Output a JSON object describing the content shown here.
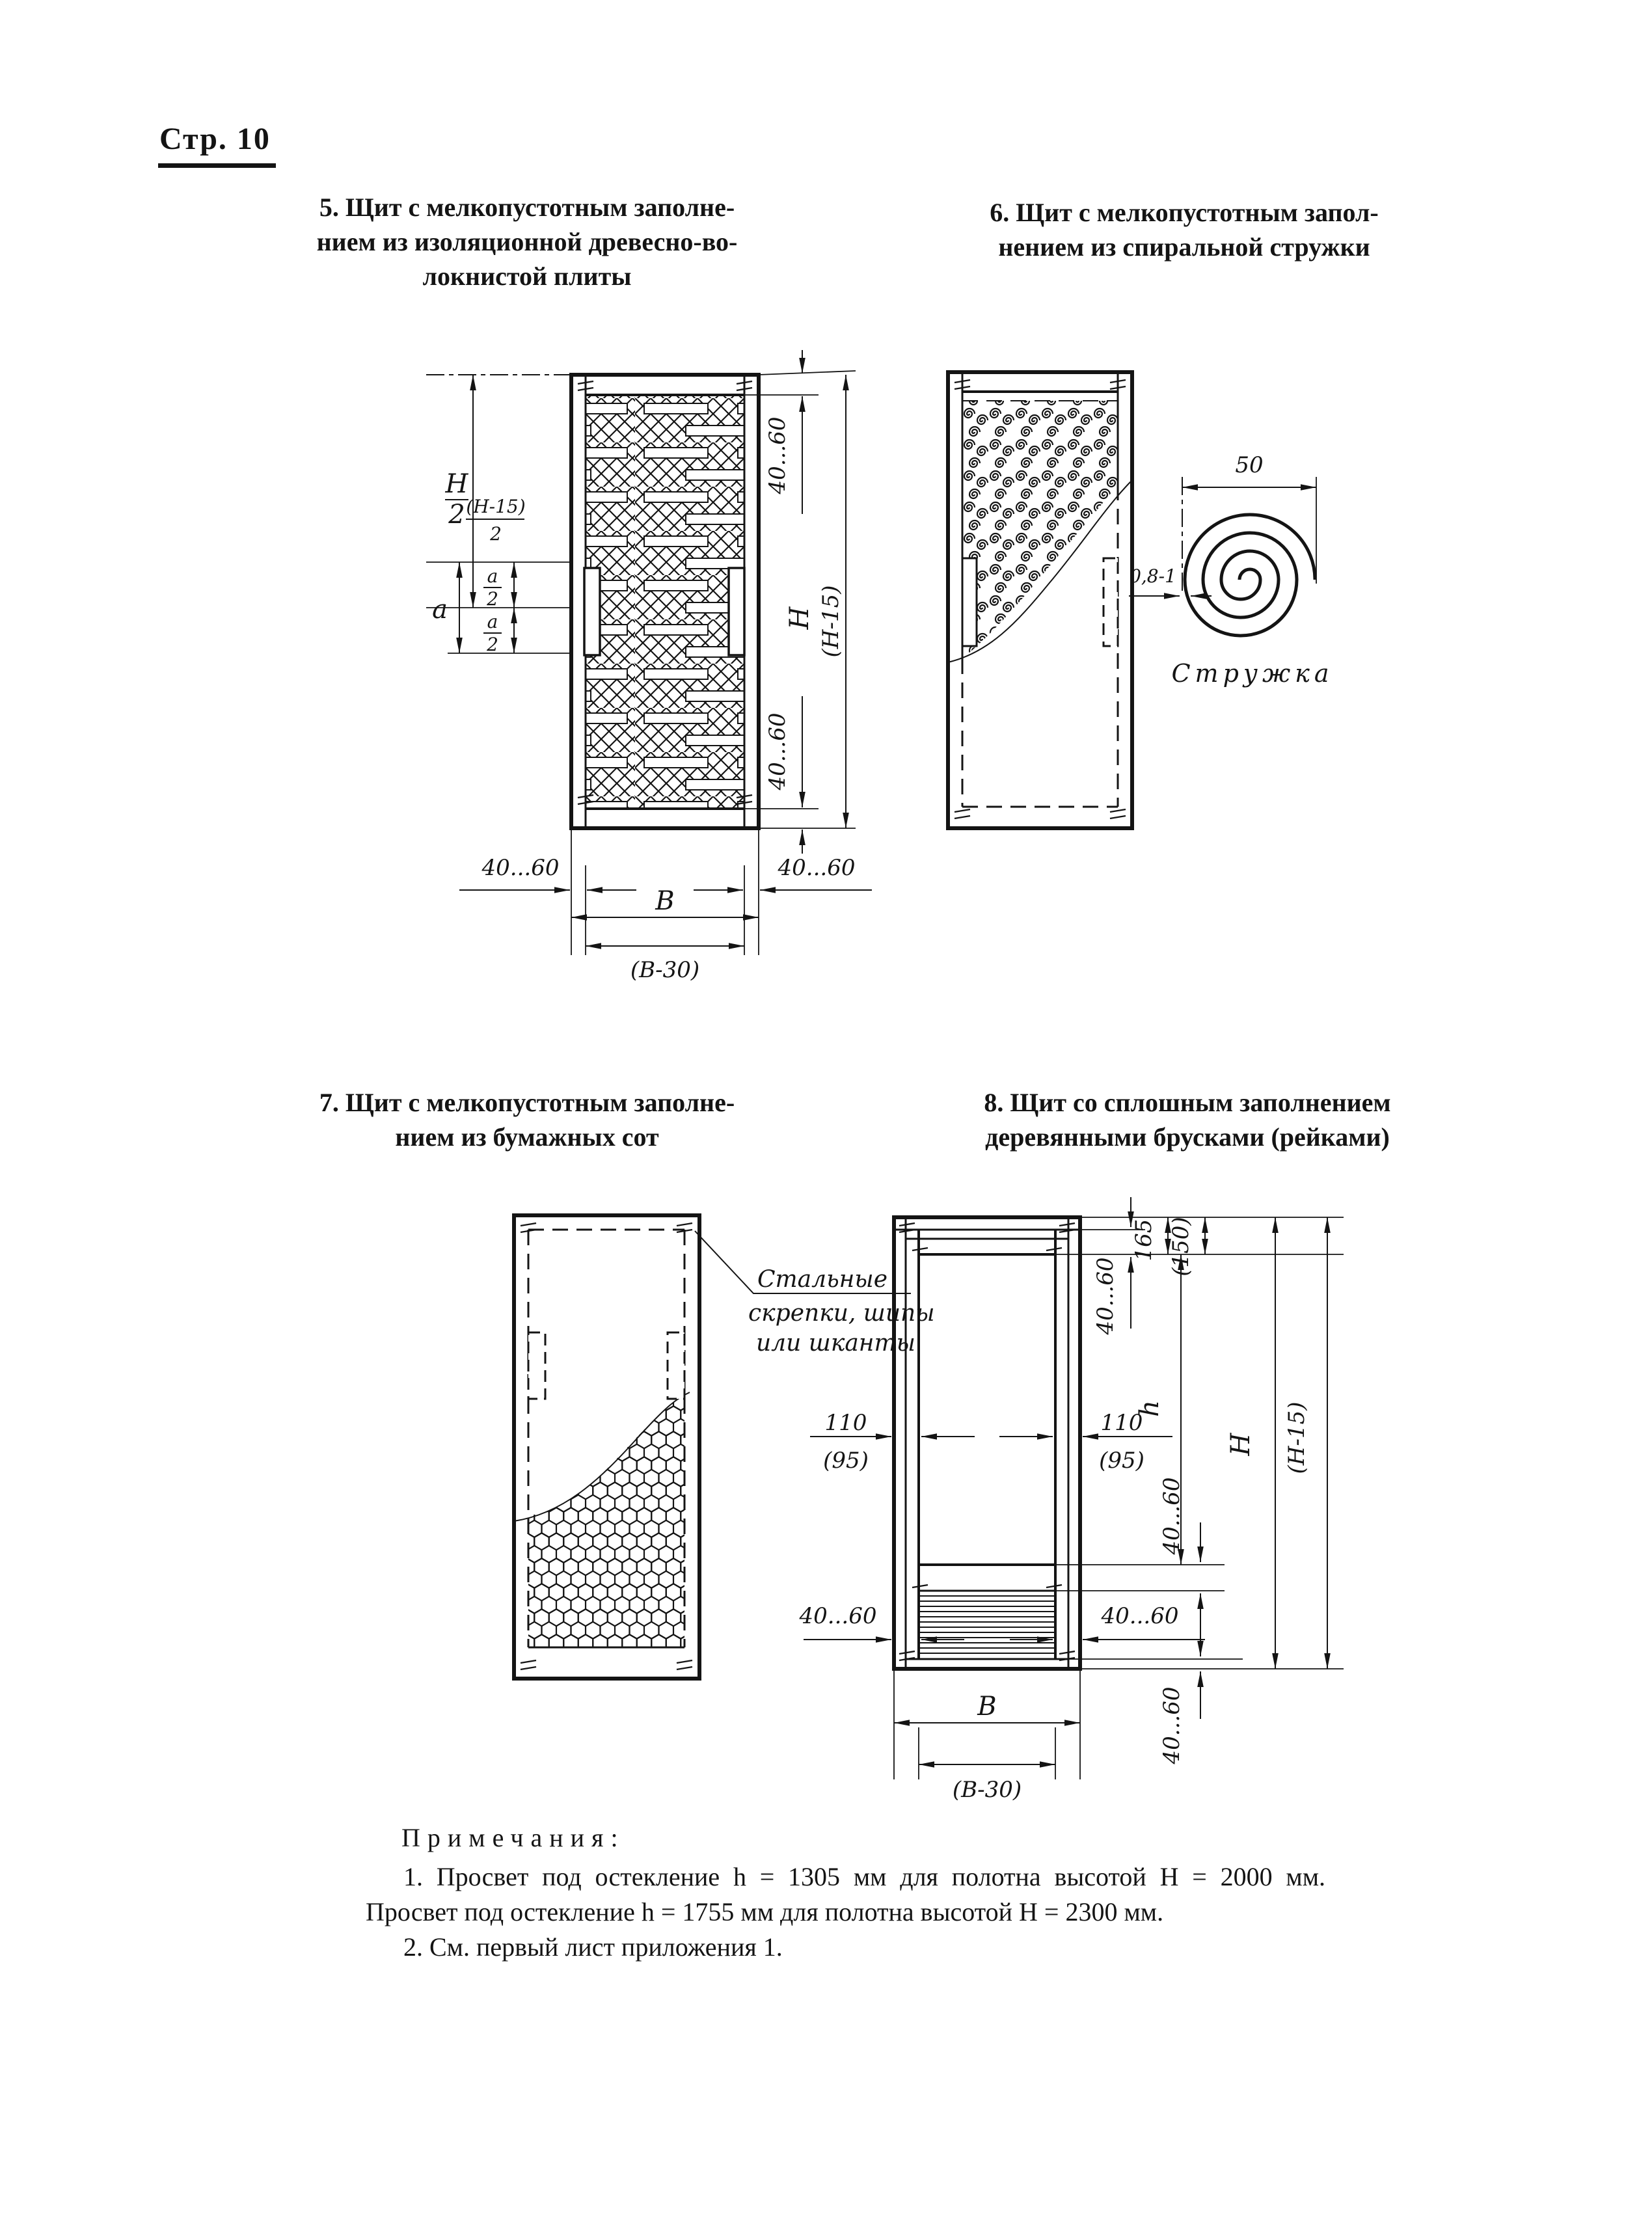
{
  "page": {
    "label": "Стр. 10"
  },
  "figures": {
    "fig5": {
      "title_lines": [
        "5. Щит с мелкопустотным заполне-",
        "нием из изоляционной древесно-во-",
        "локнистой плиты"
      ],
      "dims": {
        "half_height_num": "H",
        "half_height_den": "2",
        "half_height_alt_num": "(H-15)",
        "half_height_alt_den": "2",
        "lock_zone": "a",
        "lock_half_num": "a",
        "lock_half_den": "2",
        "top_rail": "40...60",
        "bottom_rail": "40...60",
        "stile_left": "40...60",
        "stile_right": "40...60",
        "height": "H",
        "height_alt": "(H-15)",
        "width": "В",
        "width_alt": "(В-30)"
      }
    },
    "fig6": {
      "title_lines": [
        "6. Щит с мелкопустотным запол-",
        "нением из спиральной стружки"
      ],
      "detail": {
        "width": "50",
        "thickness": "0,8-1",
        "caption": "Стружка"
      }
    },
    "fig7": {
      "title_lines": [
        "7. Щит с мелкопустотным заполне-",
        "нием из бумажных сот"
      ],
      "callout_lines": [
        "Стальные",
        "скрепки, шипы",
        "или шканты"
      ]
    },
    "fig8": {
      "title_lines": [
        "8. Щит со сплошным заполнением",
        "деревянными брусками (рейками)"
      ],
      "dims": {
        "stile_width": "110",
        "stile_width_alt": "(95)",
        "top_bar": "40...60",
        "top_rail": "165",
        "top_rail_alt": "(150)",
        "glazing_height": "h",
        "mid_bar": "40...60",
        "lath_stile_left": "40...60",
        "lath_stile_right": "40...60",
        "bottom_rail_bar": "40...60",
        "height": "H",
        "height_alt": "(H-15)",
        "width": "В",
        "width_alt": "(В-30)"
      }
    }
  },
  "notes": {
    "heading": "Примечания:",
    "items": [
      "1. Просвет под остекление h = 1305 мм для полотна высотой H = 2000 мм. Просвет под остекление h = 1755 мм для полотна высотой H = 2300 мм.",
      "2. См. первый лист приложения 1."
    ]
  }
}
